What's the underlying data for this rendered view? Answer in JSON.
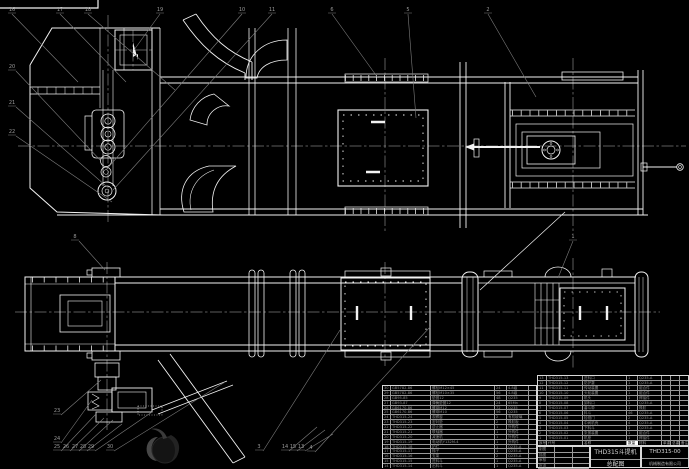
{
  "colors": {
    "background": "#000000",
    "line": "#f2f2f2",
    "leader": "#7d7d7d",
    "table_text": "#8f8f8f"
  },
  "title_block": {
    "product": "THD315斗提机",
    "sheet_name": "总配图",
    "drawing_no": "THD315-00",
    "company": "机械制造有限公司",
    "sign_rows": [
      "制图",
      "描图",
      "审核",
      "批准"
    ]
  },
  "bom": {
    "header": [
      "序号",
      "代号",
      "名称",
      "数量",
      "材料",
      "单重",
      "总重",
      "备注"
    ],
    "main_rows": [
      [
        "13",
        "THD315-13",
        "进料口",
        "1",
        "Q235-A",
        "",
        "",
        ""
      ],
      [
        "12",
        "THD315-12",
        "防护罩",
        "1",
        "Q235-A",
        "",
        "",
        ""
      ],
      [
        "11",
        "THD315-11",
        "传动装置",
        "1",
        "组合件",
        "",
        "",
        ""
      ],
      [
        "10",
        "THD315-10",
        "头轮装置",
        "1",
        "组合件",
        "",
        "",
        ""
      ],
      [
        "9",
        "THD315-09",
        "机头",
        "1",
        "焊接件",
        "",
        "",
        ""
      ],
      [
        "8",
        "THD315-08",
        "卸料口",
        "1",
        "Q235-A",
        "",
        "",
        ""
      ],
      [
        "7",
        "THD315-07",
        "畚斗带",
        "1",
        "橡胶",
        "",
        "",
        ""
      ],
      [
        "6",
        "THD315-06",
        "料斗",
        "46",
        "Q235-A",
        "",
        "",
        ""
      ],
      [
        "5",
        "THD315-05",
        "检视门",
        "2",
        "Q235-A",
        "",
        "",
        ""
      ],
      [
        "4",
        "THD315-04",
        "中间机壳",
        "4",
        "Q235-A",
        "",
        "",
        ""
      ],
      [
        "3",
        "THD315-03",
        "下料斗",
        "1",
        "Q235-A",
        "",
        "",
        ""
      ],
      [
        "2",
        "THD315-02",
        "张紧装置",
        "1",
        "组合件",
        "",
        "",
        ""
      ],
      [
        "1",
        "THD315-01",
        "机座",
        "1",
        "焊接件",
        "",
        "",
        ""
      ]
    ],
    "left_rows": [
      [
        "30",
        "GB5782-86",
        "螺栓M12×45",
        "24",
        "4.8级",
        ""
      ],
      [
        "29",
        "GB5782-86",
        "螺栓M10×35",
        "56",
        "4.8级",
        ""
      ],
      [
        "28",
        "GB95-85",
        "垫圈12",
        "48",
        "Q235",
        ""
      ],
      [
        "27",
        "GB93-87",
        "弹簧垫圈12",
        "24",
        "65Mn",
        ""
      ],
      [
        "26",
        "GB6170-86",
        "螺母M12",
        "72",
        "Q235",
        ""
      ],
      [
        "25",
        "GB6170-86",
        "螺母M10",
        "56",
        "Q235",
        ""
      ],
      [
        "24",
        "THD315-24",
        "观察窗",
        "2",
        "有机玻璃",
        ""
      ],
      [
        "23",
        "THD315-23",
        "密封垫",
        "2",
        "橡胶板",
        ""
      ],
      [
        "22",
        "THD315-22",
        "逆止器",
        "1",
        "外购件",
        ""
      ],
      [
        "21",
        "THD315-21",
        "联轴器",
        "1",
        "外购件",
        ""
      ],
      [
        "20",
        "THD315-20",
        "减速机",
        "1",
        "外购件",
        ""
      ],
      [
        "19",
        "THD315-19",
        "电动机Y132M-4",
        "1",
        "外购件",
        ""
      ],
      [
        "18",
        "THD315-18",
        "护栏",
        "1",
        "Q235-A",
        ""
      ],
      [
        "17",
        "THD315-17",
        "梯子",
        "1",
        "Q235-A",
        ""
      ],
      [
        "16",
        "THD315-16",
        "支架",
        "2",
        "Q235-A",
        ""
      ],
      [
        "15",
        "THD315-15",
        "进料斗",
        "1",
        "Q235-A",
        ""
      ],
      [
        "14",
        "THD315-14",
        "出料斗",
        "1",
        "Q235-A",
        ""
      ]
    ]
  },
  "callouts": {
    "labels": [
      "16",
      "17",
      "18",
      "19",
      "10",
      "11",
      "6",
      "5",
      "2",
      "20",
      "21",
      "22",
      "8",
      "23",
      "24",
      "25",
      "26",
      "27",
      "28",
      "29",
      "30",
      "3",
      "14",
      "15",
      "13",
      "4",
      "1"
    ]
  }
}
